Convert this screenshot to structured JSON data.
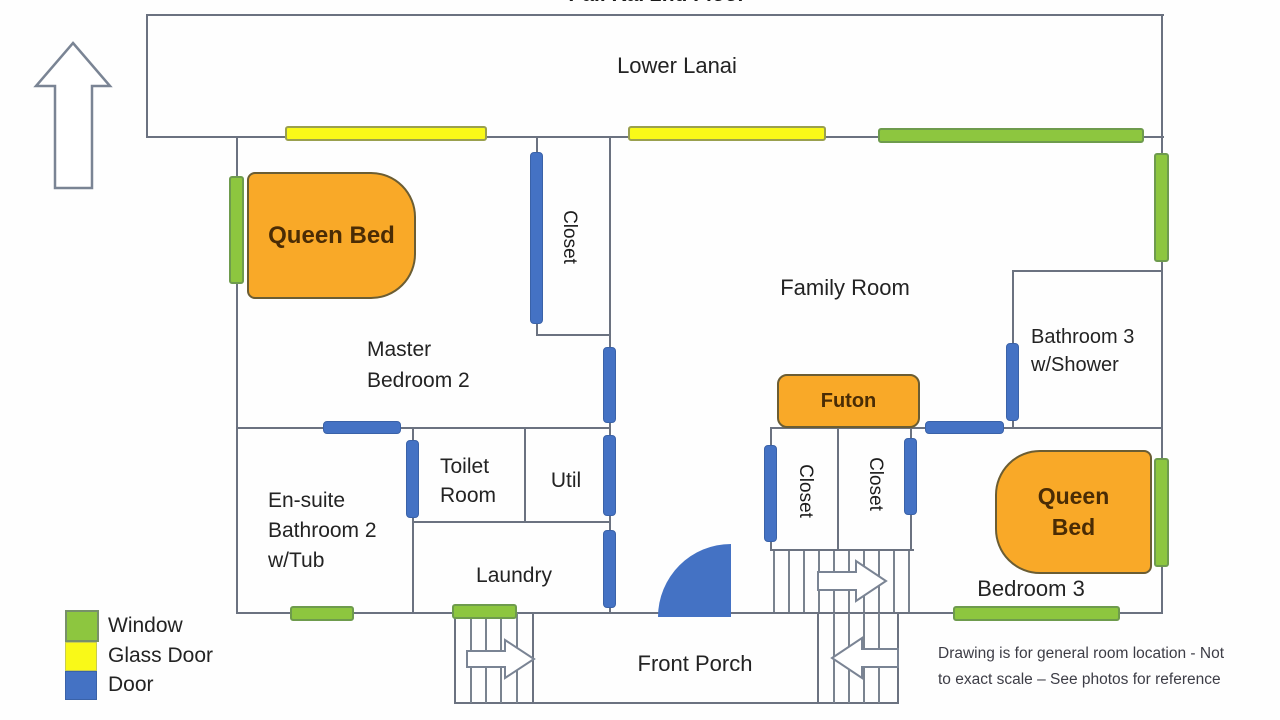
{
  "title": "Pali Kai 2nd Floor",
  "compass": {
    "label": "Ocean"
  },
  "lanai": {
    "label": "Lower Lanai"
  },
  "rooms": {
    "master_bedroom": {
      "line1": "Master",
      "line2": "Bedroom 2"
    },
    "master_closet": {
      "label": "Closet"
    },
    "family_room": {
      "label": "Family Room"
    },
    "bathroom3": {
      "line1": "Bathroom 3",
      "line2": "w/Shower"
    },
    "ensuite": {
      "line1": "En-suite",
      "line2": "Bathroom 2",
      "line3": "w/Tub"
    },
    "toilet_room": {
      "line1": "Toilet",
      "line2": "Room"
    },
    "util": {
      "label": "Util"
    },
    "laundry": {
      "label": "Laundry"
    },
    "closet_a": {
      "label": "Closet"
    },
    "closet_b": {
      "label": "Closet"
    },
    "bedroom3": {
      "label": "Bedroom 3"
    },
    "front_porch": {
      "label": "Front Porch"
    }
  },
  "furniture": {
    "master_bed": {
      "label": "Queen Bed"
    },
    "bedroom3_bed": {
      "line1": "Queen",
      "line2": "Bed"
    },
    "futon": {
      "label": "Futon"
    }
  },
  "legend": {
    "items": [
      {
        "label": "Window",
        "color": "#8dc63f"
      },
      {
        "label": "Glass Door",
        "color": "#f9f918"
      },
      {
        "label": "Door",
        "color": "#4472c4"
      }
    ]
  },
  "note": {
    "line1": "Drawing is for general room location - Not",
    "line2": "to exact scale – See photos for reference"
  },
  "colors": {
    "window": "#8dc63f",
    "glass_door": "#f9f918",
    "door": "#4472c4",
    "furniture": "#f9a928",
    "wall": "#6b7280"
  }
}
